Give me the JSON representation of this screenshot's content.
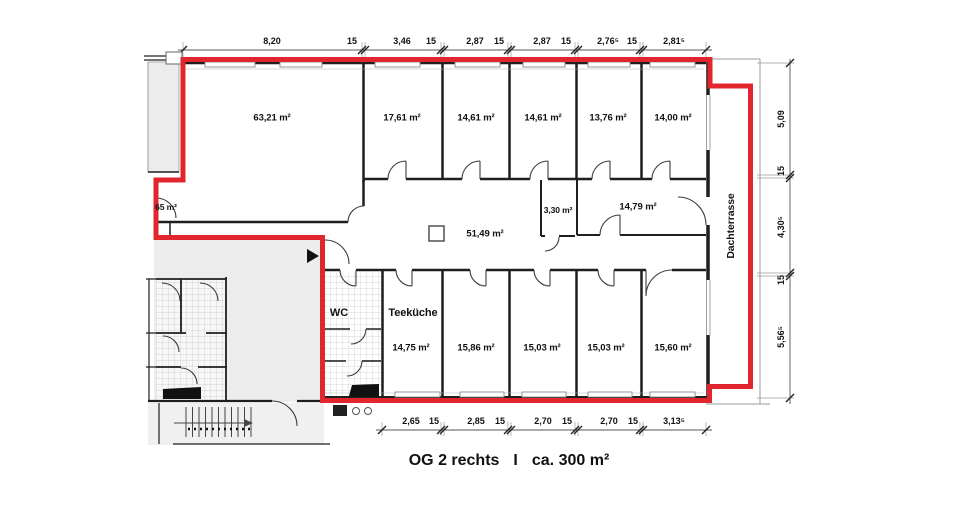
{
  "colors": {
    "boundary_red": "#e1272d"
  },
  "title": {
    "part1": "OG 2 rechts",
    "separator": "I",
    "part2": "ca. 300 m²"
  },
  "rooms": {
    "large_office": "63,21 m²",
    "office_top_1": "17,61 m²",
    "office_top_2": "14,61 m²",
    "office_top_3": "14,61 m²",
    "office_top_4": "13,76 m²",
    "office_top_5": "14,00 m²",
    "storage": "3,30 m²",
    "office_mid": "14,79 m²",
    "corridor": "51,49 m²",
    "neighbor_partial": "65 m²",
    "wc": "WC",
    "kitchen_name": "Teeküche",
    "kitchen_area": "14,75 m²",
    "office_bottom_1": "15,86 m²",
    "office_bottom_2": "15,03 m²",
    "office_bottom_3": "15,03 m²",
    "office_bottom_4": "15,60 m²",
    "terrace": "Dachterrasse"
  },
  "dimensions": {
    "top": [
      "8,20",
      "15",
      "3,46",
      "15",
      "2,87",
      "15",
      "2,87",
      "15",
      "2,76⁵",
      "15",
      "2,81⁵"
    ],
    "right": [
      "5,09",
      "15",
      "4,30⁵",
      "15",
      "5,56⁵"
    ],
    "bottom": [
      "2,65",
      "15",
      "2,85",
      "15",
      "2,70",
      "15",
      "2,70",
      "15",
      "3,13⁵"
    ]
  }
}
